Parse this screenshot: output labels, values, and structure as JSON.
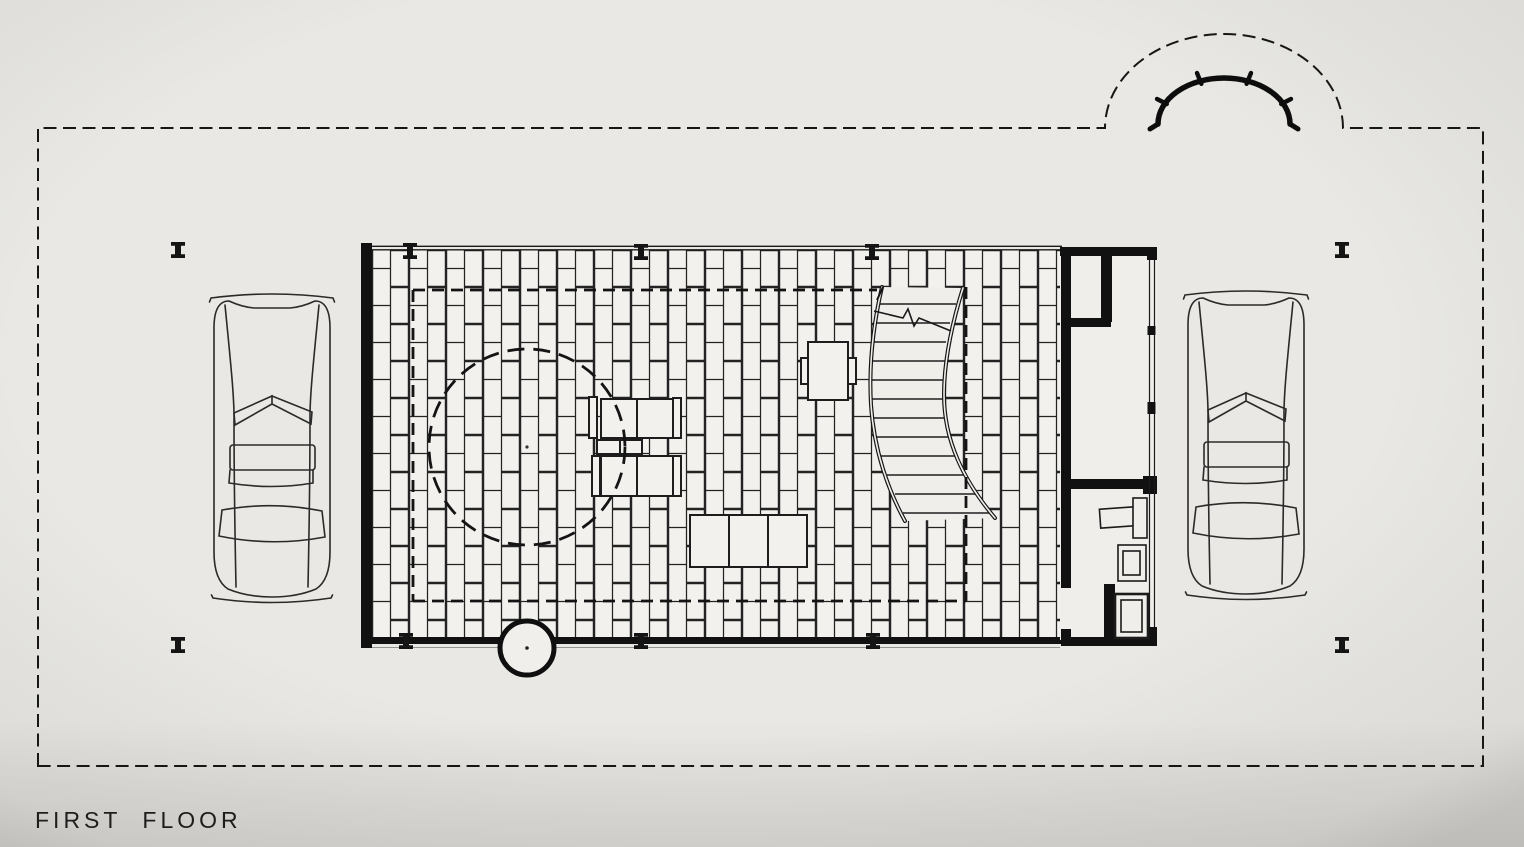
{
  "drawing": {
    "title": "FIRST FLOOR",
    "kind": "architectural floor plan, black ink line drawing on photographed paper",
    "colors": {
      "paper": "#e9e8e4",
      "ink": "#1a1a1a",
      "brick_fill": "#f2f1ee",
      "vignette": "rgba(60,55,48,0.10)"
    },
    "elements": {
      "site_boundary": "dashed rectangular property / canopy line with semicircular bump at top right",
      "entry_arc": "thick curved wall with perpendicular ticks inside dashed semicircle",
      "terrace": "rectangular floor field paved in vertical running-bond brick",
      "roof_overhang": "inner dashed rectangle over brick field",
      "round_enclosure": "large dashed circle on left of plan",
      "curved_stair": "S-curved stair with treads and section cut line",
      "service_core": "thick-walled core at right with closet, room and bathroom fixtures",
      "furniture": "two lounge chairs with side table, three-seat sofa, single armchair",
      "round_column": "heavy circle with center dot on lower terrace edge",
      "cars": "two automobiles in plan, parked left and right of terrace",
      "column_markers": "small I-beam column symbols at terrace edges and four freestanding"
    }
  }
}
